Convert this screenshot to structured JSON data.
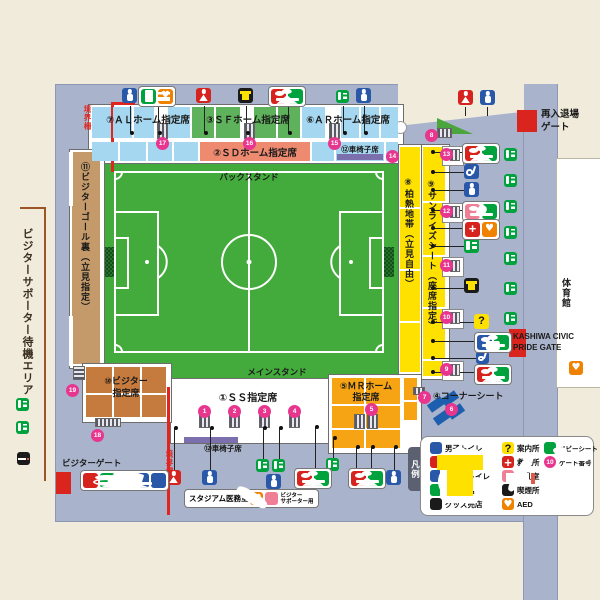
{
  "stands": {
    "back_label": "バックスタンド",
    "main_label": "メインスタンド",
    "al": "⑦ＡＬホーム指定席",
    "sf": "③ＳＦホーム指定席",
    "ar": "⑥ＡＲホーム指定席",
    "sd": "②ＳＤホーム指定席",
    "wheelchair_back": "⑫車椅子席",
    "wheelchair_main": "⑫車椅子席",
    "ss": "①ＳＳ指定席",
    "mr_line1": "⑤ＭＲホーム",
    "mr_line2": "指定席",
    "visitor_line1": "⑩ビジター",
    "visitor_line2": "指定席",
    "hakunetsu": "⑧柏熱地帯（立見自由）",
    "sunrise": "⑨サンライズシート（座席指定）",
    "corner": "④コーナーシート",
    "visitor_goal": "⑪ビジターゴール裏（立見指定）"
  },
  "labels": {
    "waiting_area": "ビジターサポーター待機エリア",
    "visitor_gate": "ビジターゲート",
    "reentry_line1": "再入退場",
    "reentry_line2": "ゲート",
    "gym": "体育館",
    "kashiwa_line1": "KASHIWA CIVIC",
    "kashiwa_line2": "PRIDE GATE",
    "boundary_top": "境界柵",
    "boundary_bottom": "境界柵",
    "medical": "スタジアム医務室",
    "supporter_line1": "ビジター",
    "supporter_line2": "サポーター用"
  },
  "gates": {
    "g1": "1",
    "g2": "2",
    "g3": "3",
    "g4": "4",
    "g5": "5",
    "g6": "6",
    "g7": "7",
    "g8": "8",
    "g9": "9",
    "g10": "10",
    "g11": "11",
    "g12": "12",
    "g13": "13",
    "g14": "14",
    "g15": "15",
    "g16": "16",
    "g17": "17",
    "g18": "18",
    "g19": "19"
  },
  "legend": {
    "tab": "凡例",
    "gate_sample": "10",
    "items": [
      {
        "icon": "male-toilet-icon",
        "label": "男子トイレ"
      },
      {
        "icon": "female-toilet-icon",
        "label": "女子トイレ"
      },
      {
        "icon": "accessible-toilet-icon",
        "label": "多目的トイレ"
      },
      {
        "icon": "food-shop-icon",
        "label": "飲食売店"
      },
      {
        "icon": "goods-shop-icon",
        "label": "グッズ売店"
      },
      {
        "icon": "information-icon",
        "label": "案内所"
      },
      {
        "icon": "first-aid-icon",
        "label": "救護所"
      },
      {
        "icon": "nursing-room-icon",
        "label": "授乳室"
      },
      {
        "icon": "smoking-area-icon",
        "label": "喫煙所"
      },
      {
        "icon": "aed-icon",
        "label": "AED"
      },
      {
        "icon": "baby-seat-icon",
        "label": "ベビーシート"
      },
      {
        "icon": "gate-number-icon",
        "label": "ゲート番号"
      }
    ]
  }
}
